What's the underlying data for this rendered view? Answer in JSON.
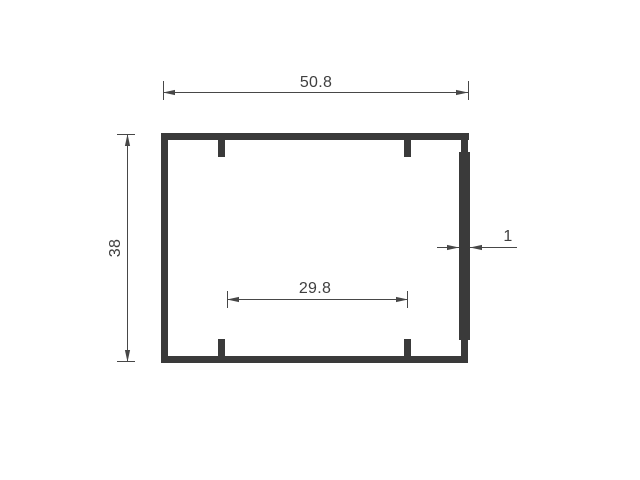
{
  "theme": {
    "background": "#ffffff",
    "profile-color": "#3a3a3a",
    "dim-color": "#474747",
    "text-color": "#3f3f3f"
  },
  "drawing": {
    "type": "technical-cross-section",
    "dimensions": {
      "overall_width": {
        "label": "50.8"
      },
      "overall_height": {
        "label": "38"
      },
      "inner_span": {
        "label": "29.8"
      },
      "wall_thickness": {
        "label": "1"
      }
    }
  }
}
